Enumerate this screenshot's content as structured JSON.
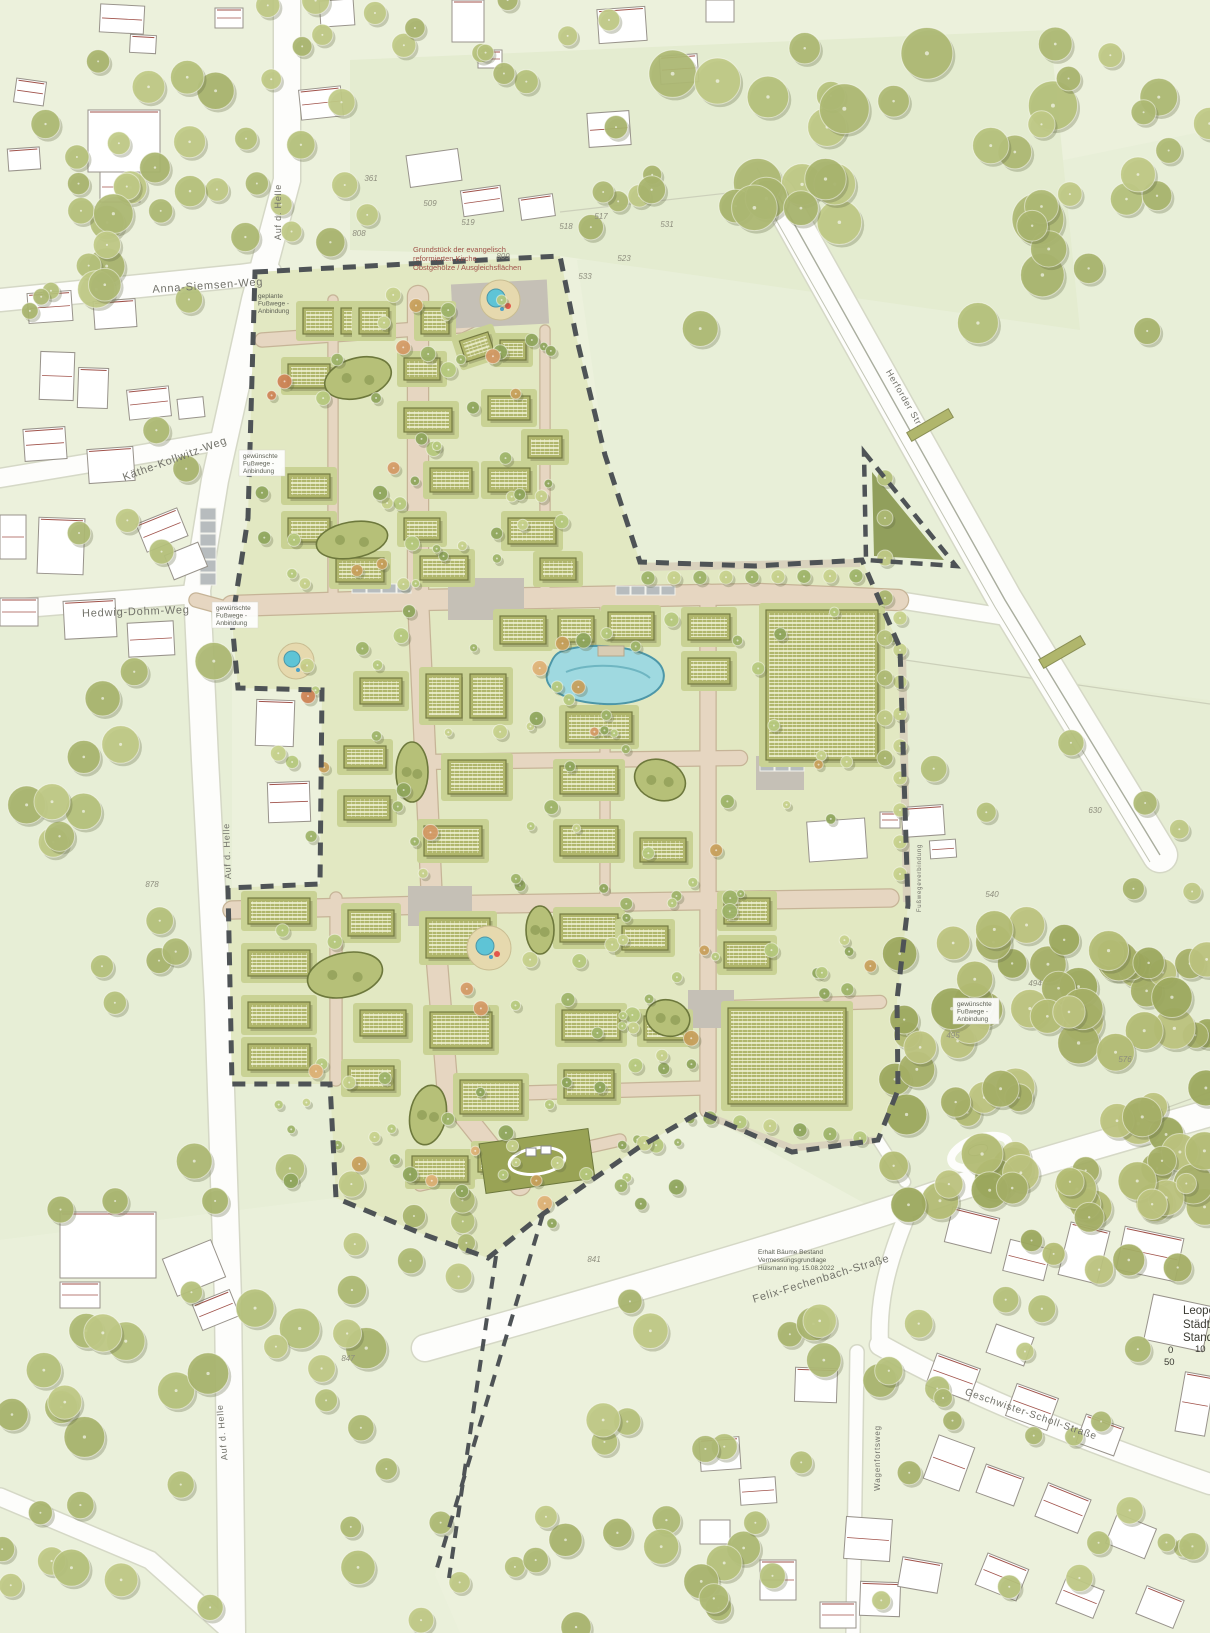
{
  "street_labels": [
    {
      "text": "Anna-Siemsen-Weg",
      "x": 208,
      "y": 289,
      "rot": -4,
      "size": 11
    },
    {
      "text": "Käthe-Kollwitz-Weg",
      "x": 176,
      "y": 462,
      "rot": -20,
      "size": 11
    },
    {
      "text": "Hedwig-Dohm-Weg",
      "x": 136,
      "y": 615,
      "rot": -2,
      "size": 11
    },
    {
      "text": "Auf d. Helle",
      "x": 281,
      "y": 212,
      "rot": -90,
      "size": 9
    },
    {
      "text": "Auf d. Helle",
      "x": 230,
      "y": 851,
      "rot": -92,
      "size": 9
    },
    {
      "text": "Auf d. Helle",
      "x": 225,
      "y": 1432,
      "rot": -95,
      "size": 9
    },
    {
      "text": "Herforder Str.",
      "x": 902,
      "y": 400,
      "rot": 60,
      "size": 9
    },
    {
      "text": "Felix-Fechenbach-Straße",
      "x": 822,
      "y": 1282,
      "rot": -17,
      "size": 11
    },
    {
      "text": "Geschwister-Scholl-Straße",
      "x": 1030,
      "y": 1417,
      "rot": 19,
      "size": 10
    },
    {
      "text": "Wagenfortsweg",
      "x": 880,
      "y": 1458,
      "rot": -90,
      "size": 8
    },
    {
      "text": "Fußwegeverbindung",
      "x": 921,
      "y": 878,
      "rot": -90,
      "size": 6
    }
  ],
  "path_annotations": [
    {
      "lines": [
        "geplante",
        "Fußwege -",
        "Anbindung"
      ],
      "x": 258,
      "y": 298,
      "box": false
    },
    {
      "lines": [
        "gewünschte",
        "Fußwege -",
        "Anbindung"
      ],
      "x": 243,
      "y": 458,
      "box": true
    },
    {
      "lines": [
        "gewünschte",
        "Fußwege -",
        "Anbindung"
      ],
      "x": 216,
      "y": 610,
      "box": true
    },
    {
      "lines": [
        "gewünschte",
        "Fußwege -",
        "Anbindung"
      ],
      "x": 957,
      "y": 1006,
      "box": true
    }
  ],
  "notes": [
    {
      "lines": [
        "Grundstück der evangelisch",
        "reformierten Kirche",
        "Obstgehölze / Ausgleichsflächen"
      ],
      "x": 413,
      "y": 252,
      "size": 7.5,
      "red": true
    },
    {
      "lines": [
        "Erhalt Bäume Bestand",
        "Vermessungsgrundlage",
        "Hülsmann Ing. 15.08.2022"
      ],
      "x": 758,
      "y": 1254,
      "size": 6.5,
      "red": false
    }
  ],
  "parcel_numbers": [
    {
      "text": "361",
      "x": 371,
      "y": 181
    },
    {
      "text": "509",
      "x": 430,
      "y": 206
    },
    {
      "text": "519",
      "x": 468,
      "y": 225
    },
    {
      "text": "517",
      "x": 601,
      "y": 219
    },
    {
      "text": "518",
      "x": 566,
      "y": 229
    },
    {
      "text": "531",
      "x": 667,
      "y": 227
    },
    {
      "text": "523",
      "x": 624,
      "y": 261
    },
    {
      "text": "533",
      "x": 585,
      "y": 279
    },
    {
      "text": "808",
      "x": 359,
      "y": 236
    },
    {
      "text": "809",
      "x": 503,
      "y": 259
    },
    {
      "text": "630",
      "x": 1095,
      "y": 813
    },
    {
      "text": "540",
      "x": 992,
      "y": 897
    },
    {
      "text": "494",
      "x": 1035,
      "y": 986
    },
    {
      "text": "495",
      "x": 953,
      "y": 1038
    },
    {
      "text": "576",
      "x": 1125,
      "y": 1062
    },
    {
      "text": "878",
      "x": 152,
      "y": 887
    },
    {
      "text": "841",
      "x": 594,
      "y": 1262
    },
    {
      "text": "847",
      "x": 348,
      "y": 1361
    }
  ],
  "title_block": {
    "line1": "Leopo",
    "line2": "Städte",
    "line3": "Stand",
    "scale": {
      "t0": "0",
      "t10": "10",
      "t50": "50"
    }
  },
  "colors": {
    "background": "#ecf1dc",
    "field_a": "#e8efd8",
    "field_b": "#e4ecd0",
    "field_c": "#e7eed6",
    "field_d": "#eaf0da",
    "field_e": "#e6edd4",
    "road": "#fdfdfb",
    "road_casing": "#d5d8c6",
    "site_ground": "#e2e8c2",
    "site_street": "#e6d6c1",
    "street_casing": "#c6b497",
    "plaza": "#c5c0b6",
    "lawn": "#c9d294",
    "building_new": "#b0b66c",
    "building_edge": "#757b42",
    "building_existing": "#ffffff",
    "existing_edge": "#98938b",
    "red_line": "#a0524a",
    "water": "#9fd9e0",
    "water_edge": "#4d97a8",
    "boundary": "#4e5356",
    "hedge": "#b6c078",
    "hedge_edge": "#6d783c",
    "plantation": "#87964f",
    "tree_out": [
      "#b6c27c",
      "#aebา74",
      "#c0ca86",
      "#a9b56e"
    ],
    "sand": "#e6d9ae",
    "pool": "#5ec4d6"
  }
}
